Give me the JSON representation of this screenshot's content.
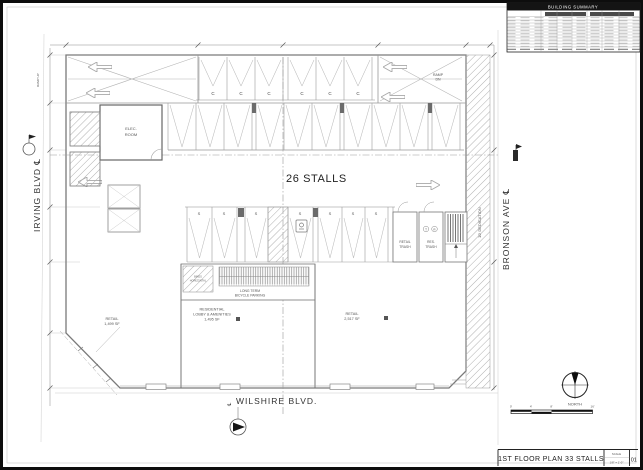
{
  "summary_table": {
    "title": "BUILDING  SUMMARY"
  },
  "title_block": {
    "title": "1ST FLOOR PLAN  33 STALLS",
    "scale_label": "SCALE",
    "scale_value": "1/8\" = 1'-0\"",
    "sheet_number": "01"
  },
  "compass": {
    "north_label": "NORTH"
  },
  "scale_bar": {
    "t0": "0'",
    "t1": "4'",
    "t2": "8'",
    "t3": "16'"
  },
  "streets": {
    "left": "IRVING BLVD ℄",
    "right": "BRONSON AVE ℄",
    "bottom": "WILSHIRE  BLVD.",
    "bottom_centerline": "℄",
    "dedication": "10' DEDICATION"
  },
  "plan": {
    "center_label": "26 STALLS",
    "ramp_up": "RAMP UP",
    "ramp_dn_line1": "RAMP",
    "ramp_dn_line2": "DN",
    "stall_compact": "C",
    "stall_standard": "S",
    "marker_t": "T",
    "marker_r": "R"
  },
  "rooms": {
    "elec_line1": "ELEC.",
    "elec_line2": "ROOM",
    "retail_trash_line1": "RETAIL",
    "retail_trash_line2": "TRASH",
    "res_trash_line1": "RES.",
    "res_trash_line2": "TRASH",
    "bike_line1": "LONG TERM",
    "bike_line2": "BICYCLE PARKING",
    "bike_store_line1": "BIKES",
    "bike_store_line2": "HORIZONTAL",
    "retail_left_line1": "RETAIL",
    "retail_left_line2": "1,499 SF",
    "lobby_line1": "RESIDENTIAL",
    "lobby_line2": "LOBBY & AMENITIES",
    "lobby_line3": "1,495 SF",
    "retail_right_line1": "RETAIL",
    "retail_right_line2": "2,517 SF"
  }
}
